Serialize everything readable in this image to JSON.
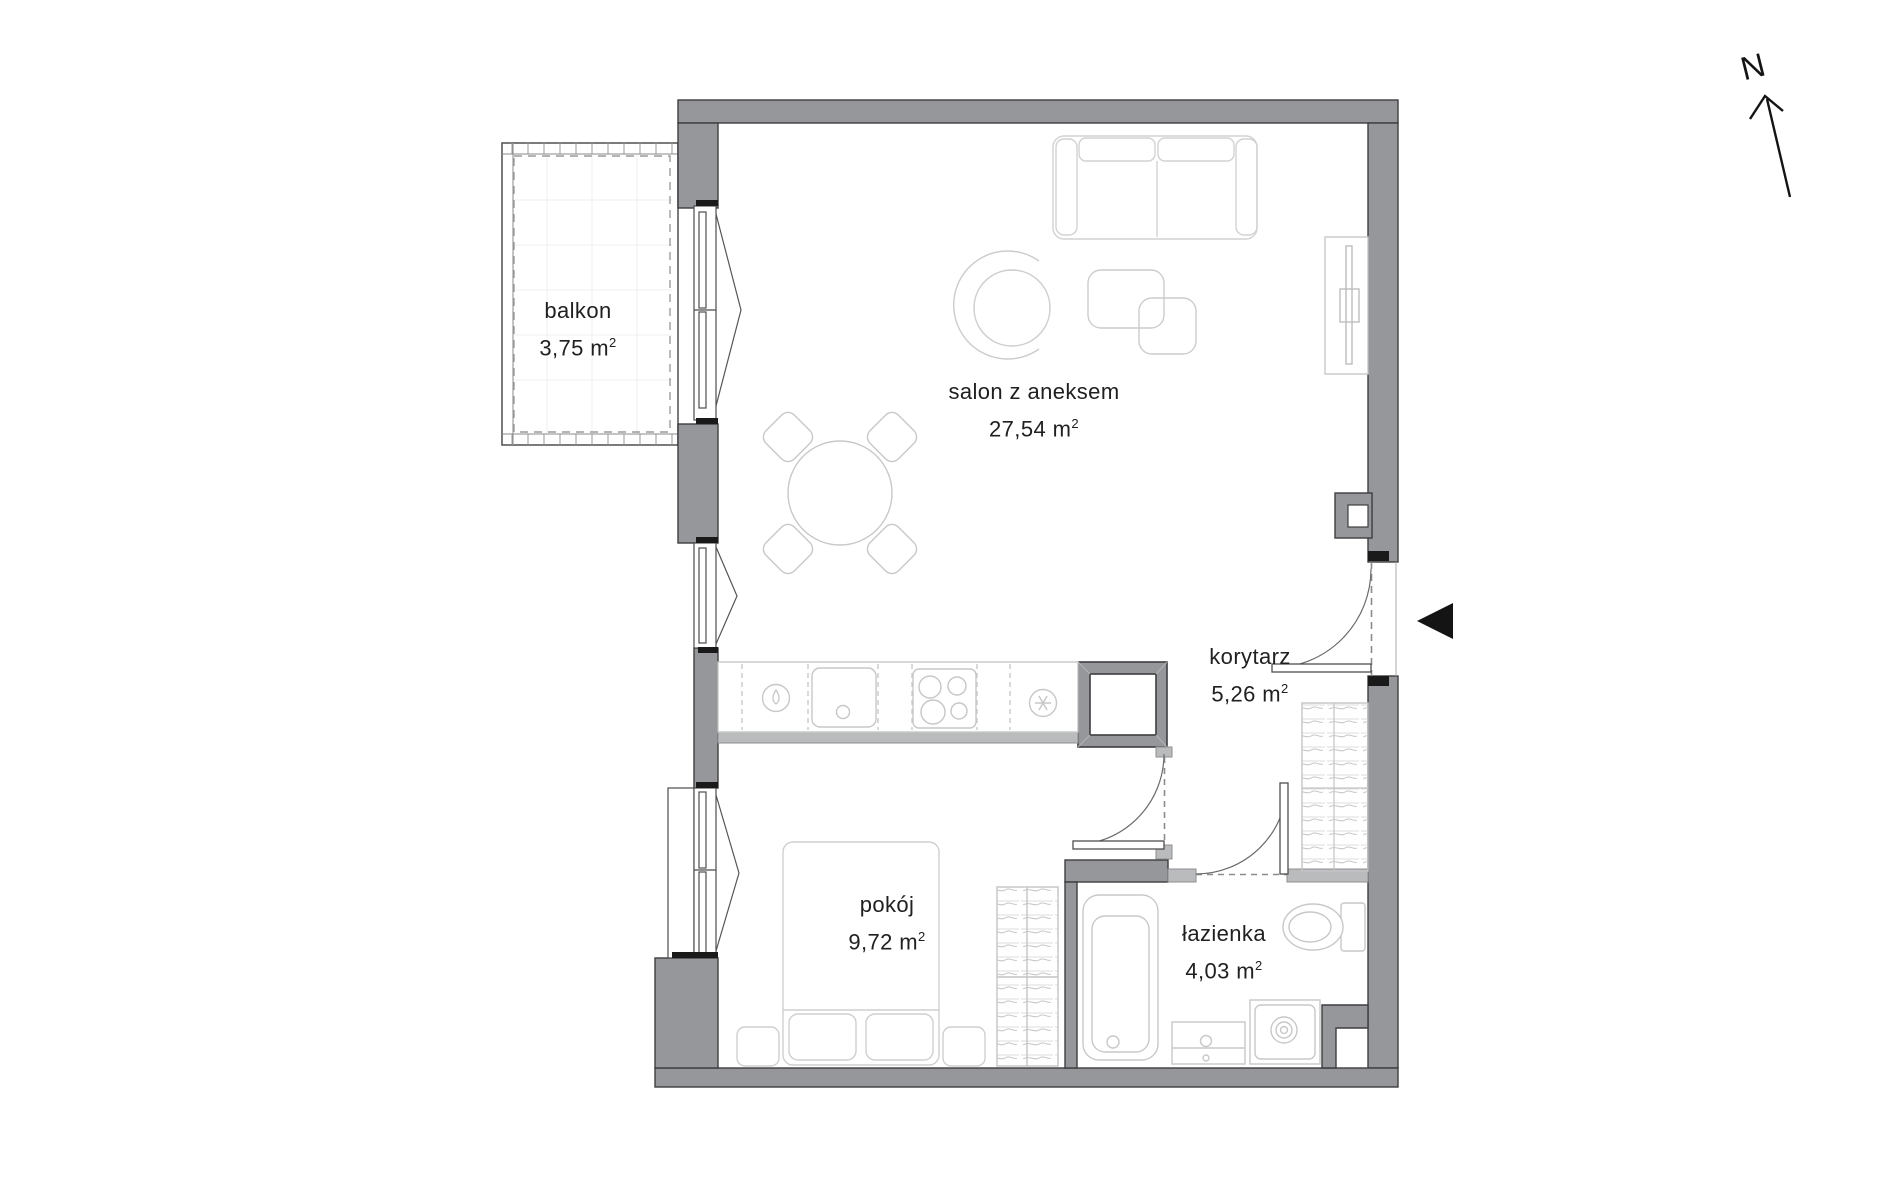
{
  "compass": {
    "label": "N"
  },
  "rooms": [
    {
      "id": "balkon",
      "name": "balkon",
      "area_value": "3,75 m",
      "area_sup": "2"
    },
    {
      "id": "salon",
      "name": "salon z aneksem",
      "area_value": "27,54 m",
      "area_sup": "2"
    },
    {
      "id": "korytarz",
      "name": "korytarz",
      "area_value": "5,26 m",
      "area_sup": "2"
    },
    {
      "id": "pokoj",
      "name": "pokój",
      "area_value": "9,72 m",
      "area_sup": "2"
    },
    {
      "id": "lazienka",
      "name": "łazienka",
      "area_value": "4,03 m",
      "area_sup": "2"
    }
  ],
  "colors": {
    "wall": "#95979b",
    "wall_light": "#babbbd",
    "outline": "#3e3e40",
    "furniture_line": "#cdcdcd",
    "text": "#202022",
    "marker_black": "#141414"
  },
  "icons": {
    "entrance_marker": "left-pointing-triangle",
    "compass_arrow": "north-arrow"
  }
}
